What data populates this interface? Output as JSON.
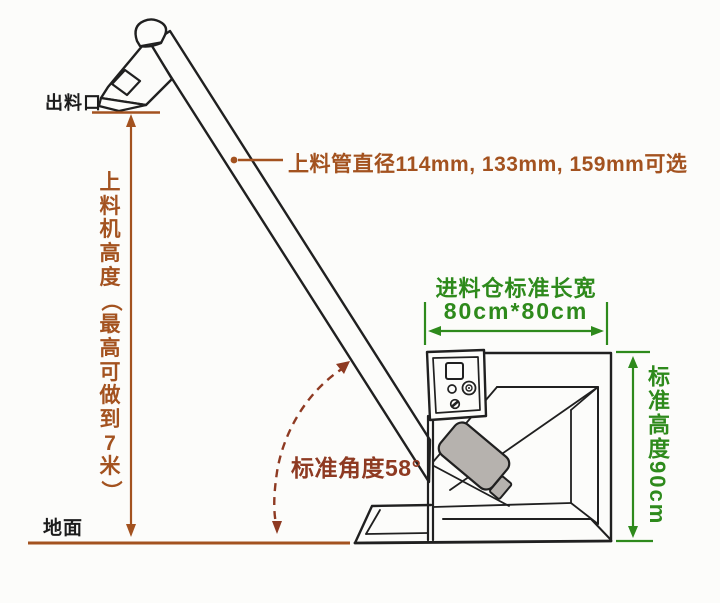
{
  "labels": {
    "outlet": "出料口",
    "ground": "地面",
    "pipe_diameter": "上料管直径114mm, 133mm, 159mm可选",
    "machine_height": "上料机高度（最高可做到7米）",
    "standard_angle": "标准角度58°",
    "hopper_size_title": "进料仓标准长宽",
    "hopper_size_value": "80cm*80cm",
    "standard_height": "标准高度90cm"
  },
  "colors": {
    "background": "#fcfcfa",
    "line_art": "#202020",
    "annotation_brown": "#a3521f",
    "annotation_dark_red": "#8e3a22",
    "annotation_green": "#2e8a1c",
    "motor_gray": "#b6b2ae",
    "black_text": "#1c1c1c"
  },
  "dimensions": {
    "pipe_diameter_options_mm": [
      114,
      133,
      159
    ],
    "max_machine_height_m": 7,
    "standard_angle_deg": 58,
    "hopper_length_width_cm": "80*80",
    "hopper_standard_height_cm": 90
  }
}
